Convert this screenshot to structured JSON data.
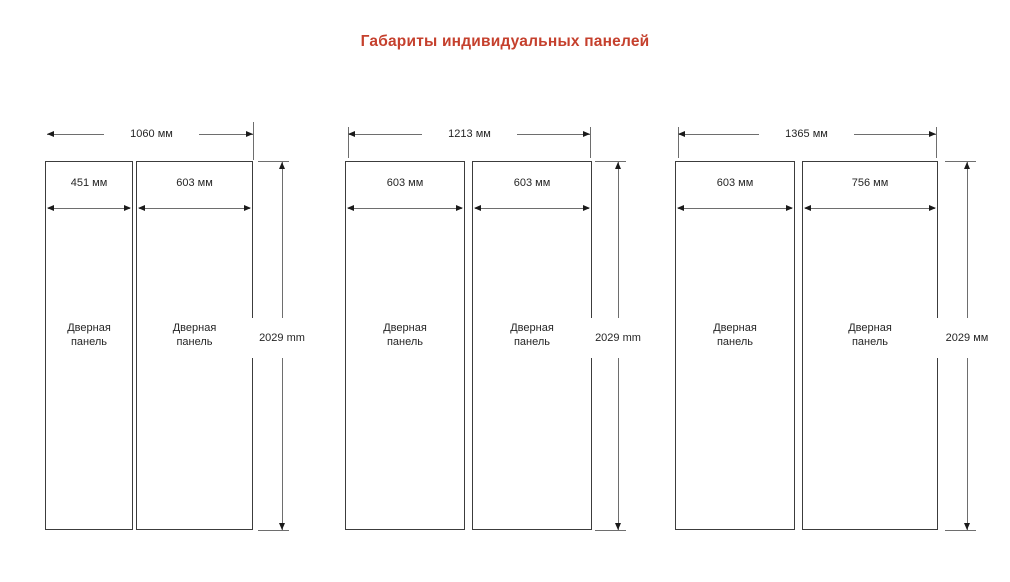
{
  "title": "Габариты индивидуальных панелей",
  "colors": {
    "accent": "#c5402d",
    "line": "#6e6e6e",
    "ink": "#262626"
  },
  "groups": [
    {
      "total_width": "1060 мм",
      "height": "2029 mm",
      "panels": [
        {
          "width": "451 мм",
          "label": "Дверная панель"
        },
        {
          "width": "603 мм",
          "label": "Дверная панель"
        }
      ]
    },
    {
      "total_width": "1213 мм",
      "height": "2029 mm",
      "panels": [
        {
          "width": "603 мм",
          "label": "Дверная панель"
        },
        {
          "width": "603 мм",
          "label": "Дверная панель"
        }
      ]
    },
    {
      "total_width": "1365 мм",
      "height": "2029 мм",
      "panels": [
        {
          "width": "603 мм",
          "label": "Дверная панель"
        },
        {
          "width": "756 мм",
          "label": "Дверная панель"
        }
      ]
    }
  ]
}
